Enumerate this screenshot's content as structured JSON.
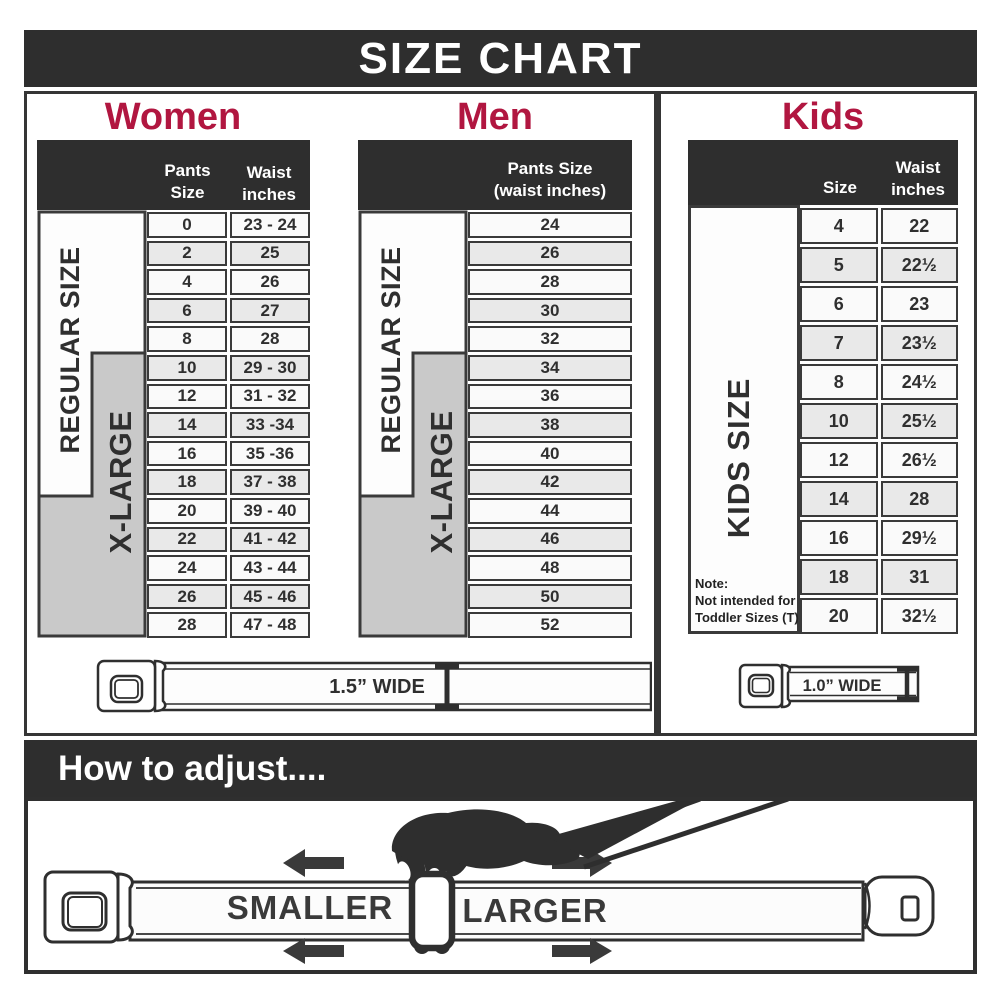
{
  "title": "SIZE CHART",
  "colors": {
    "dark": "#2e2e2e",
    "accent_red": "#b11640",
    "cell_border": "#3a3a3a",
    "gray_fill": "#c9c9c9"
  },
  "women": {
    "title": "Women",
    "regular_label": "REGULAR SIZE",
    "xlarge_label": "X-LARGE",
    "col_pants": "Pants Size",
    "col_waist_1": "Waist",
    "col_waist_2": "inches",
    "rows": [
      {
        "size": "0",
        "waist": "23 - 24"
      },
      {
        "size": "2",
        "waist": "25"
      },
      {
        "size": "4",
        "waist": "26"
      },
      {
        "size": "6",
        "waist": "27"
      },
      {
        "size": "8",
        "waist": "28"
      },
      {
        "size": "10",
        "waist": "29 - 30"
      },
      {
        "size": "12",
        "waist": "31 - 32"
      },
      {
        "size": "14",
        "waist": "33 -34"
      },
      {
        "size": "16",
        "waist": "35 -36"
      },
      {
        "size": "18",
        "waist": "37 - 38"
      },
      {
        "size": "20",
        "waist": "39 - 40"
      },
      {
        "size": "22",
        "waist": "41 - 42"
      },
      {
        "size": "24",
        "waist": "43 - 44"
      },
      {
        "size": "26",
        "waist": "45 - 46"
      },
      {
        "size": "28",
        "waist": "47 - 48"
      }
    ]
  },
  "men": {
    "title": "Men",
    "regular_label": "REGULAR SIZE",
    "xlarge_label": "X-LARGE",
    "col_1": "Pants Size",
    "col_2": "(waist inches)",
    "rows": [
      "24",
      "26",
      "28",
      "30",
      "32",
      "34",
      "36",
      "38",
      "40",
      "42",
      "44",
      "46",
      "48",
      "50",
      "52"
    ]
  },
  "kids": {
    "title": "Kids",
    "vertical_label": "KIDS SIZE",
    "col_size": "Size",
    "col_waist_1": "Waist",
    "col_waist_2": "inches",
    "note_1": "Note:",
    "note_2": "Not intended for",
    "note_3": "Toddler Sizes (T)",
    "rows": [
      {
        "size": "4",
        "waist": "22"
      },
      {
        "size": "5",
        "waist": "22½"
      },
      {
        "size": "6",
        "waist": "23"
      },
      {
        "size": "7",
        "waist": "23½"
      },
      {
        "size": "8",
        "waist": "24½"
      },
      {
        "size": "10",
        "waist": "25½"
      },
      {
        "size": "12",
        "waist": "26½"
      },
      {
        "size": "14",
        "waist": "28"
      },
      {
        "size": "16",
        "waist": "29½"
      },
      {
        "size": "18",
        "waist": "31"
      },
      {
        "size": "20",
        "waist": "32½"
      }
    ]
  },
  "belts": {
    "adult_width_label": "1.5” WIDE",
    "kids_width_label": "1.0” WIDE"
  },
  "adjust": {
    "title": "How to adjust....",
    "smaller": "SMALLER",
    "larger": "LARGER"
  }
}
